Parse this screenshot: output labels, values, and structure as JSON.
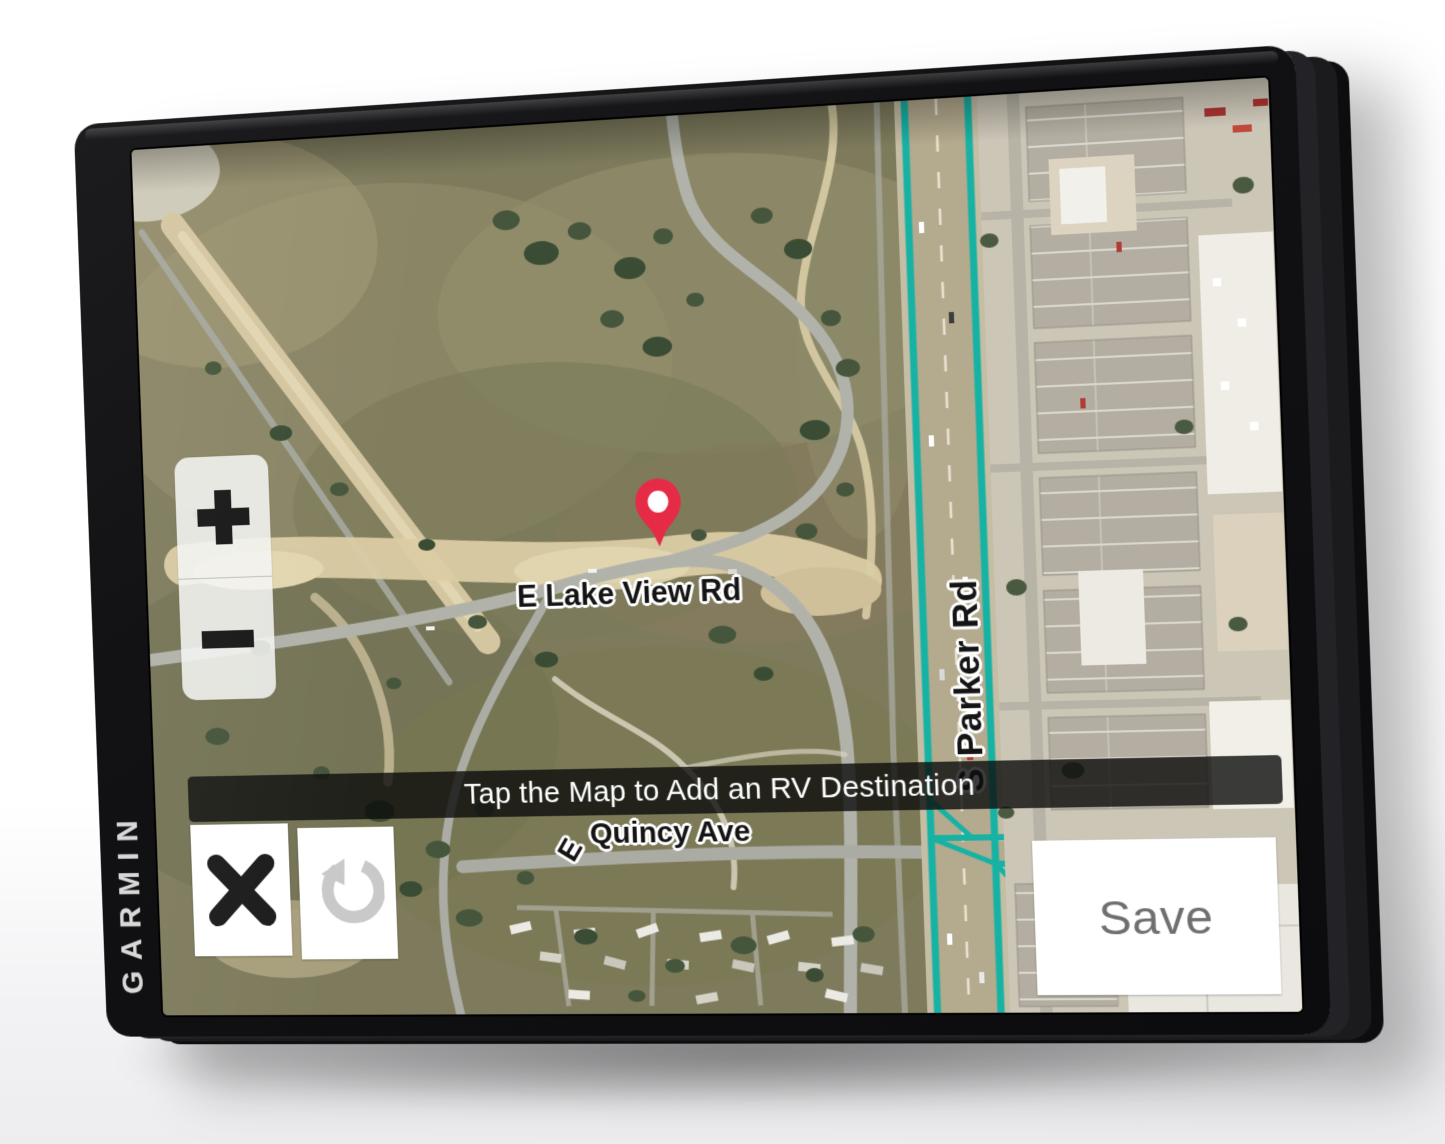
{
  "device": {
    "brand": "GARMIN"
  },
  "map_screen": {
    "message_bar_text": "Tap the Map to Add an RV Destination",
    "save_button_label": "Save",
    "road_labels": {
      "lake_view": "E Lake View Rd",
      "quincy_prefix": "E",
      "quincy": "Quincy Ave",
      "parker": "S Parker Rd"
    },
    "icons": {
      "zoom_in": "plus-icon",
      "zoom_out": "minus-icon",
      "close": "close-x-icon",
      "undo": "undo-arrow-icon",
      "marker": "location-pin-icon"
    },
    "colors": {
      "highway_teal": "#16b2a4",
      "pin_red": "#e62b47",
      "message_bar_bg": "#0c0c0c",
      "save_text": "#6f6f6f"
    }
  }
}
